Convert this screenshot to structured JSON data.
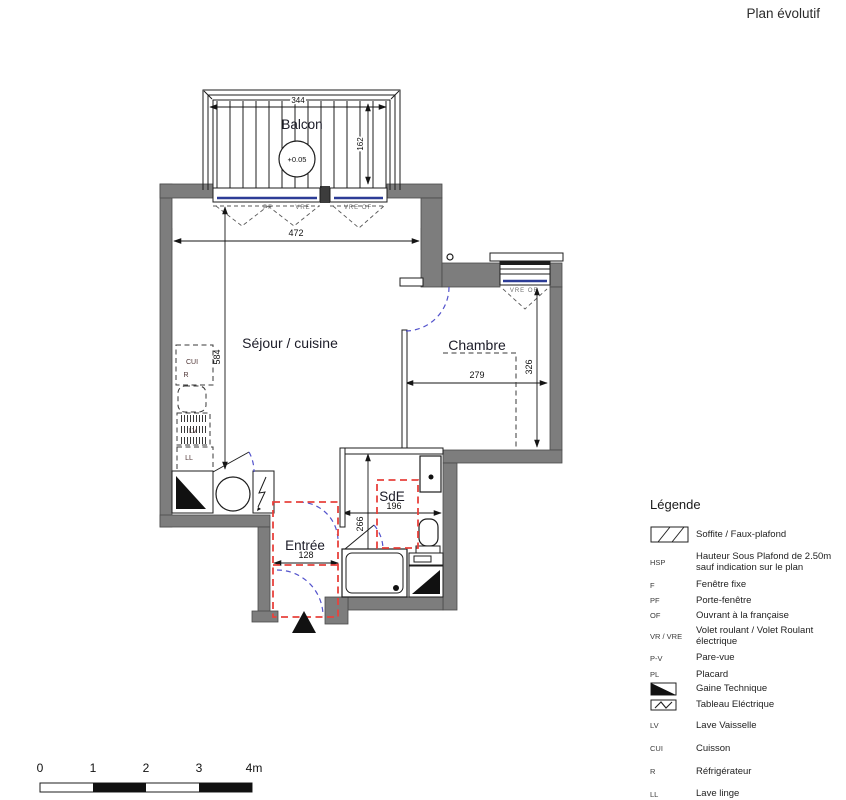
{
  "title": "Plan évolutif",
  "plan": {
    "rooms": {
      "balcony": "Balcon",
      "living": "Séjour / cuisine",
      "bedroom": "Chambre",
      "shower_room": "SdE",
      "entry": "Entrée"
    },
    "level_marker": "+0.05",
    "dimensions": {
      "balcony_width": "344",
      "balcony_depth": "162",
      "living_width": "472",
      "living_height": "584",
      "bedroom_width": "279",
      "bedroom_height": "326",
      "shower_width": "196",
      "shower_height": "266",
      "entry_width": "128"
    },
    "window_labels": {
      "balcony_left_pf": "PF",
      "balcony_left_vre": "VRE",
      "balcony_right": "VRE  OF",
      "bedroom": "VRE  OF"
    },
    "appliances": {
      "hob": "CUI",
      "fridge": "R",
      "dishwasher": "LV",
      "washer": "LL"
    }
  },
  "legend": {
    "heading": "Légende",
    "rows": [
      {
        "key": "",
        "label": "Soffite / Faux-plafond"
      },
      {
        "key": "HSP",
        "label": "Hauteur Sous Plafond de 2.50m",
        "label2": "sauf indication sur le plan"
      },
      {
        "key": "F",
        "label": "Fenêtre fixe"
      },
      {
        "key": "PF",
        "label": "Porte-fenêtre"
      },
      {
        "key": "OF",
        "label": "Ouvrant à la française"
      },
      {
        "key": "VR / VRE",
        "label": "Volet roulant / Volet Roulant électrique"
      },
      {
        "key": "P-V",
        "label": "Pare-vue"
      },
      {
        "key": "PL",
        "label": "Placard"
      },
      {
        "key": "",
        "label": "Gaine Technique"
      },
      {
        "key": "",
        "label": "Tableau Eléctrique"
      },
      {
        "key": "LV",
        "label": "Lave Vaisselle"
      },
      {
        "key": "CUI",
        "label": "Cuisson"
      },
      {
        "key": "R",
        "label": "Réfrigérateur"
      },
      {
        "key": "LL",
        "label": "Lave linge"
      },
      {
        "key": "",
        "label": "Fenêtre de toit"
      }
    ]
  },
  "scale_bar": {
    "ticks": [
      "0",
      "1",
      "2",
      "3",
      "4m"
    ]
  },
  "colors": {
    "wall": "#7d7d7d",
    "red_zone": "#e8423d",
    "door_swing": "#5353cc",
    "glazing": "#2c3c96"
  }
}
